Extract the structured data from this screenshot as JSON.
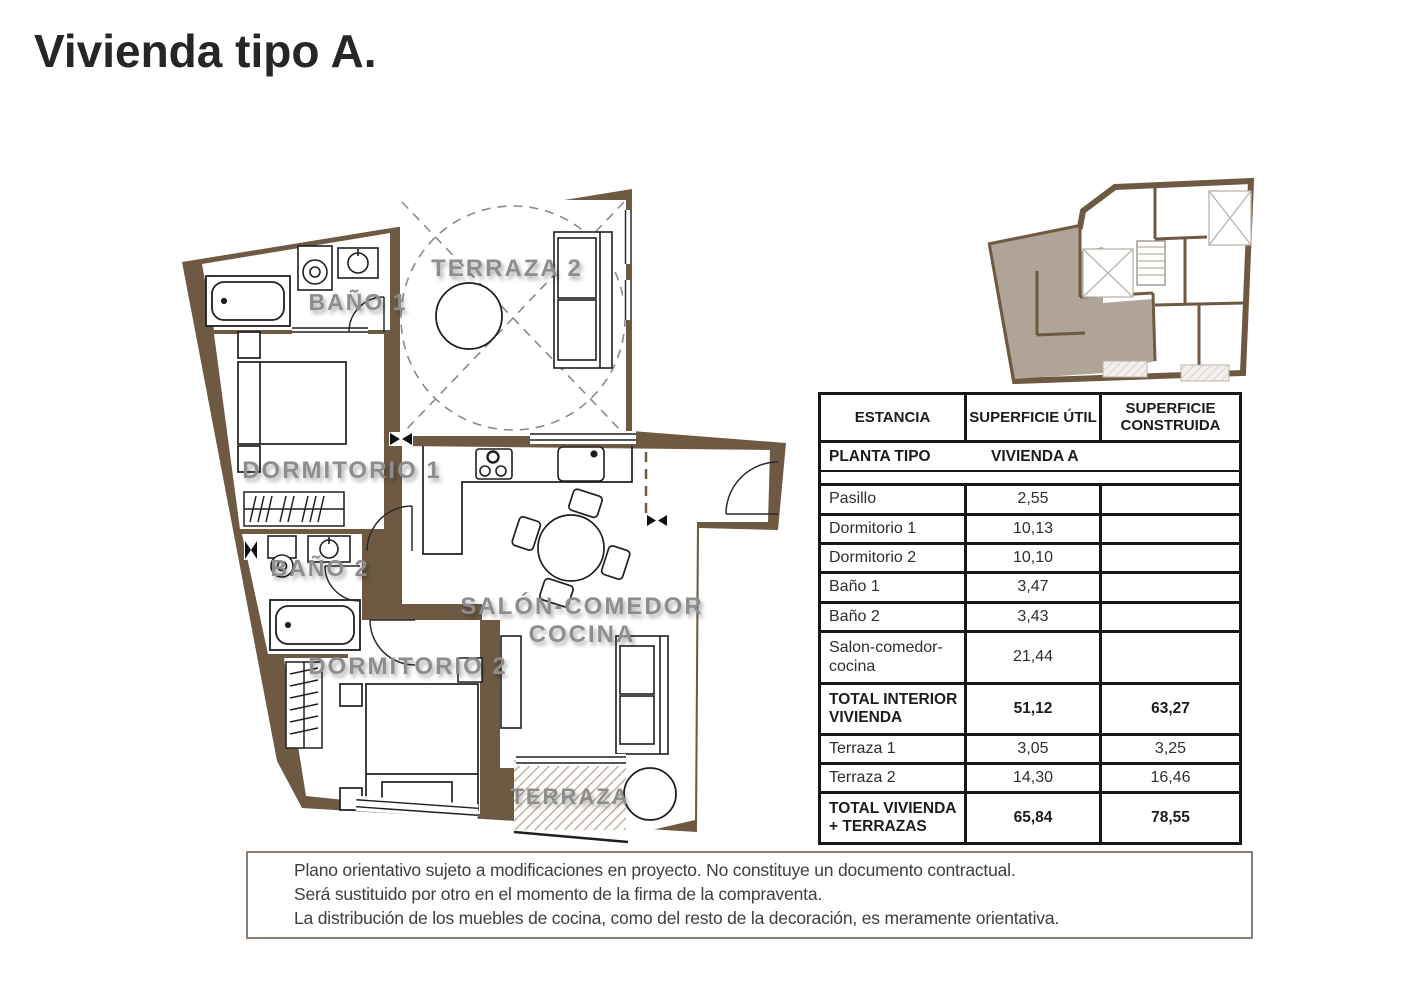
{
  "title": "Vivienda tipo A.",
  "floor_plan": {
    "labels": {
      "terraza2": "TERRAZA 2",
      "bano1": "BAÑO 1",
      "dormitorio1": "DORMITORIO 1",
      "bano2": "BAÑO 2",
      "dormitorio2": "DORMITORIO 2",
      "salon1": "SALÓN-COMEDOR",
      "salon2": "COCINA",
      "terraza": "TERRAZA"
    }
  },
  "table": {
    "headers": {
      "estancia": "ESTANCIA",
      "util": "SUPERFICIE ÚTIL",
      "construida": "SUPERFICIE CONSTRUIDA"
    },
    "subheader": {
      "left": "PLANTA TIPO",
      "right": "VIVIENDA A"
    },
    "rows": [
      {
        "estancia": "Pasillo",
        "util": "2,55",
        "construida": ""
      },
      {
        "estancia": "Dormitorio 1",
        "util": "10,13",
        "construida": ""
      },
      {
        "estancia": "Dormitorio 2",
        "util": "10,10",
        "construida": ""
      },
      {
        "estancia": "Baño 1",
        "util": "3,47",
        "construida": ""
      },
      {
        "estancia": "Baño 2",
        "util": "3,43",
        "construida": ""
      },
      {
        "estancia": "Salon-comedor-cocina",
        "util": "21,44",
        "construida": ""
      },
      {
        "estancia": "TOTAL INTERIOR VIVIENDA",
        "util": "51,12",
        "construida": "63,27"
      },
      {
        "estancia": "Terraza 1",
        "util": "3,05",
        "construida": "3,25"
      },
      {
        "estancia": "Terraza 2",
        "util": "14,30",
        "construida": "16,46"
      },
      {
        "estancia": "TOTAL VIVIENDA + TERRAZAS",
        "util": "65,84",
        "construida": "78,55"
      }
    ]
  },
  "disclaimer": {
    "lines": [
      "Plano orientativo sujeto a modificaciones en proyecto. No constituye un documento contractual.",
      "Será sustituido por otro en el momento de la firma de la compraventa.",
      "La distribución de los muebles de cocina, como del resto de la decoración, es meramente orientativa."
    ]
  },
  "colors": {
    "wall": "#6e5a42",
    "unit_highlight": "#b0a498",
    "label_gray": "#8d8d8d"
  }
}
